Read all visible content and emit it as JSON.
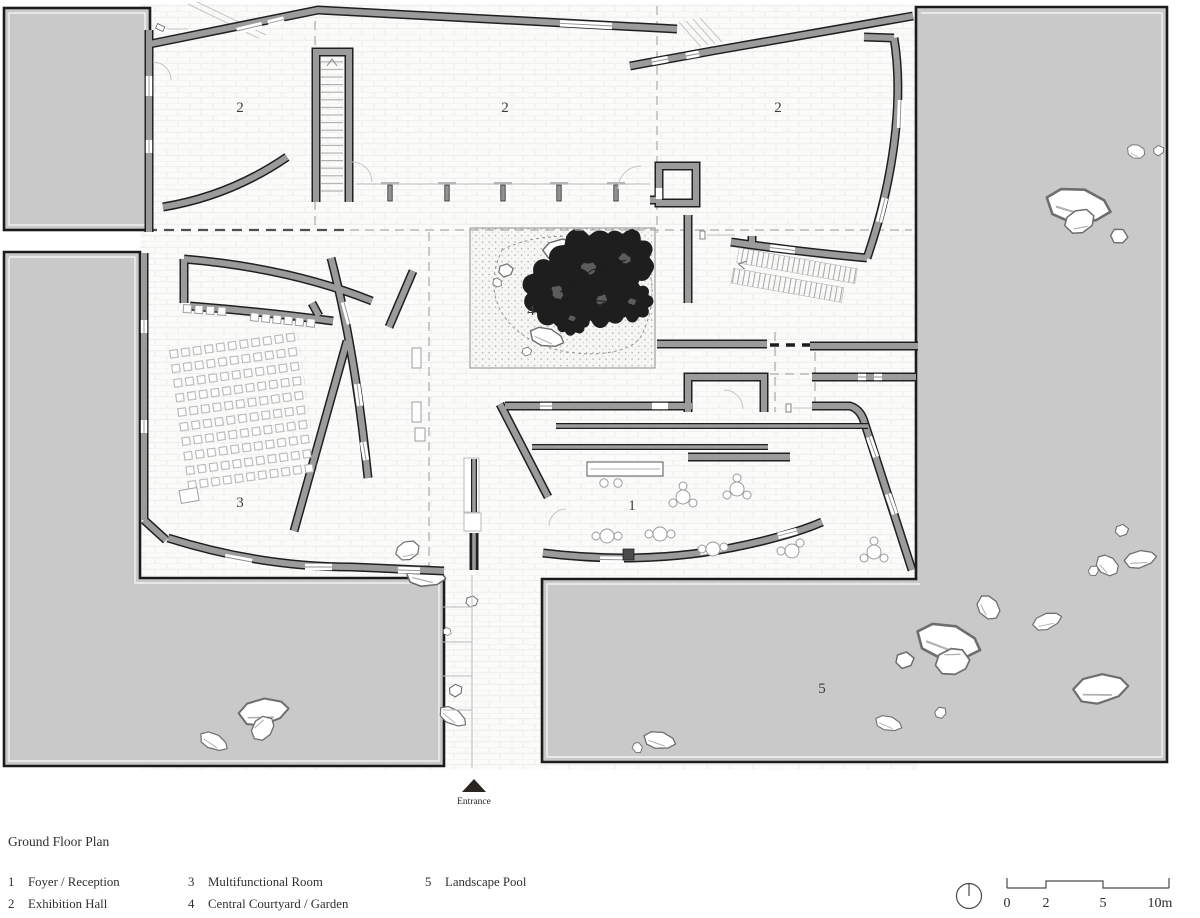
{
  "title": "Ground Floor Plan",
  "plan": {
    "rooms": [
      {
        "name": "exhibition-hall-left",
        "num": "2"
      },
      {
        "name": "exhibition-hall-middle",
        "num": "2"
      },
      {
        "name": "exhibition-hall-right",
        "num": "2"
      },
      {
        "name": "multifunctional-room",
        "num": "3"
      },
      {
        "name": "central-courtyard",
        "num": "4"
      },
      {
        "name": "foyer-reception",
        "num": "1"
      },
      {
        "name": "landscape-pool",
        "num": "5"
      }
    ],
    "entrance_label": "Entrance"
  },
  "legend": {
    "title": "Ground Floor Plan",
    "items": [
      {
        "num": "1",
        "label": "Foyer / Reception"
      },
      {
        "num": "2",
        "label": "Exhibition Hall"
      },
      {
        "num": "3",
        "label": "Multifunctional Room"
      },
      {
        "num": "4",
        "label": "Central Courtyard / Garden"
      },
      {
        "num": "5",
        "label": "Landscape Pool"
      }
    ]
  },
  "scale_bar": {
    "ticks": [
      "0",
      "2",
      "5",
      "10m"
    ]
  },
  "colors": {
    "pool": "#c9c9c9",
    "wall": "#9b9b9b",
    "dark": "#1f1f1f",
    "tree": "#5c5c5c",
    "text": "#2f2f2f"
  }
}
